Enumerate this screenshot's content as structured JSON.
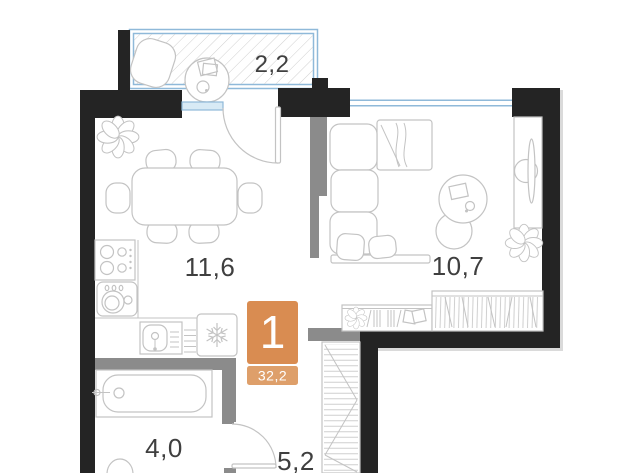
{
  "plan_type": "apartment-floor-plan",
  "rooms": [
    {
      "name": "balcony",
      "area": "2,2"
    },
    {
      "name": "kitchen-dining",
      "area": "11,6"
    },
    {
      "name": "living-room",
      "area": "10,7"
    },
    {
      "name": "bathroom",
      "area": "4,0"
    },
    {
      "name": "hallway",
      "area": "5,2"
    }
  ],
  "badge": {
    "rooms_count": "1",
    "total_area": "32,2"
  },
  "icons": [
    "flower-plant-icon",
    "snowflake-fridge-icon",
    "stove-burners-icon",
    "washing-machine-icon",
    "sink-icon",
    "bathtub-icon",
    "sofa-icon",
    "tv-stand-icon",
    "dining-table-icon",
    "lounge-chair-icon",
    "coffee-table-icon",
    "wardrobe-hatch-icon",
    "door-swing-icon"
  ],
  "colors": {
    "wall": "#242424",
    "partition": "#8b8b8b",
    "window": "#8fb9d9",
    "window_fill": "#d8eaf5",
    "furniture": "#c3c3c3",
    "hatch": "#cfcfcf",
    "label": "#3f3f3f",
    "accent": "#d98c51",
    "accent_light": "#de9f6a",
    "shadow": "#dadada"
  }
}
